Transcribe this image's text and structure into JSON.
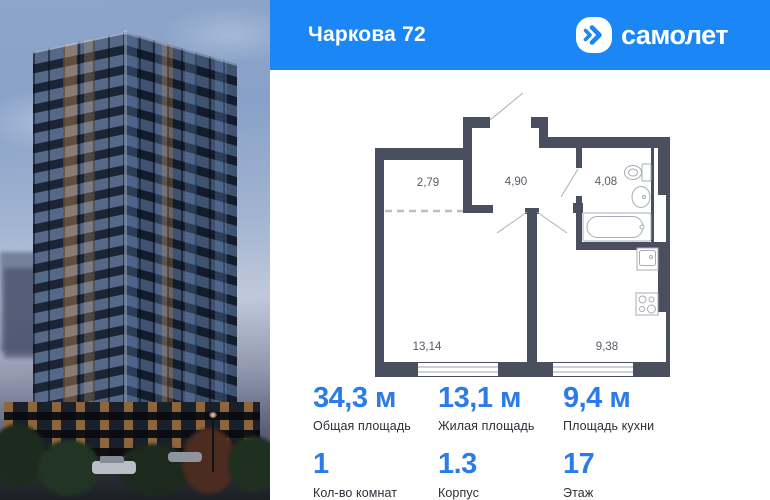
{
  "header": {
    "title": "Чаркова 72",
    "brand": "самолет",
    "brand_icon": "samolet-arrow-icon"
  },
  "floorplan": {
    "rooms": [
      {
        "name": "wardrobe",
        "area": "2,79"
      },
      {
        "name": "hallway",
        "area": "4,90"
      },
      {
        "name": "bathroom",
        "area": "4,08"
      },
      {
        "name": "living-room",
        "area": "13,14"
      },
      {
        "name": "kitchen",
        "area": "9,38"
      }
    ],
    "fixtures": [
      "toilet-icon",
      "sink-icon",
      "bathtub-icon",
      "kitchen-sink-icon",
      "stove-icon"
    ]
  },
  "stats": [
    {
      "value": "34,3 м",
      "label": "Общая площадь"
    },
    {
      "value": "13,1 м",
      "label": "Жилая площадь"
    },
    {
      "value": "9,4 м",
      "label": "Площадь кухни"
    },
    {
      "value": "1",
      "label": "Кол-во комнат"
    },
    {
      "value": "1.3",
      "label": "Корпус"
    },
    {
      "value": "17",
      "label": "Этаж"
    }
  ],
  "colors": {
    "brand_blue": "#1b87f7",
    "value_blue": "#2b7ce9",
    "wall_gray": "#4a4f60",
    "label_dark": "#2b2f38"
  }
}
